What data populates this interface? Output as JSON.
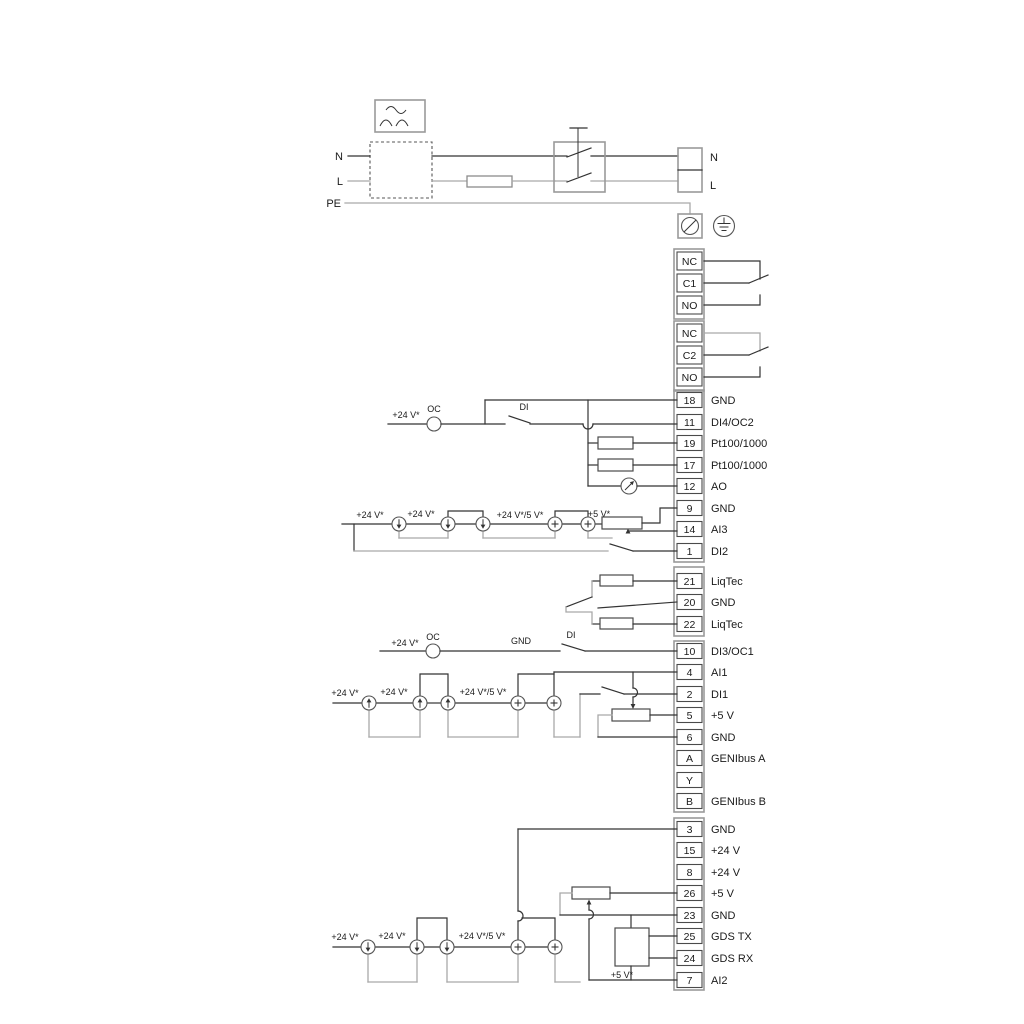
{
  "power": {
    "n_in": "N",
    "l_in": "L",
    "pe": "PE",
    "n_out": "N",
    "l_out": "L"
  },
  "relay1": {
    "nc": "NC",
    "c": "C1",
    "no": "NO"
  },
  "relay2": {
    "nc": "NC",
    "c": "C2",
    "no": "NO"
  },
  "strip1": [
    {
      "num": "18",
      "label": "GND"
    },
    {
      "num": "11",
      "label": "DI4/OC2"
    },
    {
      "num": "19",
      "label": "Pt100/1000"
    },
    {
      "num": "17",
      "label": "Pt100/1000"
    },
    {
      "num": "12",
      "label": "AO"
    },
    {
      "num": "9",
      "label": "GND"
    },
    {
      "num": "14",
      "label": "AI3"
    },
    {
      "num": "1",
      "label": "DI2"
    }
  ],
  "liqtec": [
    {
      "num": "21",
      "label": "LiqTec"
    },
    {
      "num": "20",
      "label": "GND"
    },
    {
      "num": "22",
      "label": "LiqTec"
    }
  ],
  "strip2": [
    {
      "num": "10",
      "label": "DI3/OC1"
    },
    {
      "num": "4",
      "label": "AI1"
    },
    {
      "num": "2",
      "label": "DI1"
    },
    {
      "num": "5",
      "label": "+5 V"
    },
    {
      "num": "6",
      "label": "GND"
    },
    {
      "num": "A",
      "label": "GENIbus A"
    },
    {
      "num": "Y",
      "label": "GENIbus Y"
    },
    {
      "num": "B",
      "label": "GENIbus B"
    }
  ],
  "strip3": [
    {
      "num": "3",
      "label": "GND"
    },
    {
      "num": "15",
      "label": "+24 V"
    },
    {
      "num": "8",
      "label": "+24 V"
    },
    {
      "num": "26",
      "label": "+5 V"
    },
    {
      "num": "23",
      "label": "GND"
    },
    {
      "num": "25",
      "label": "GDS TX"
    },
    {
      "num": "24",
      "label": "GDS RX"
    },
    {
      "num": "7",
      "label": "AI2"
    }
  ],
  "notes": {
    "v24": "+24 V*",
    "v24_5": "+24 V*/5 V*",
    "v5": "+5 V*",
    "oc": "OC",
    "di": "DI",
    "gnd": "GND"
  },
  "colors": {
    "wire": "#333333",
    "wire_gray": "#a9a9a9",
    "frame": "#9a9a9a"
  }
}
